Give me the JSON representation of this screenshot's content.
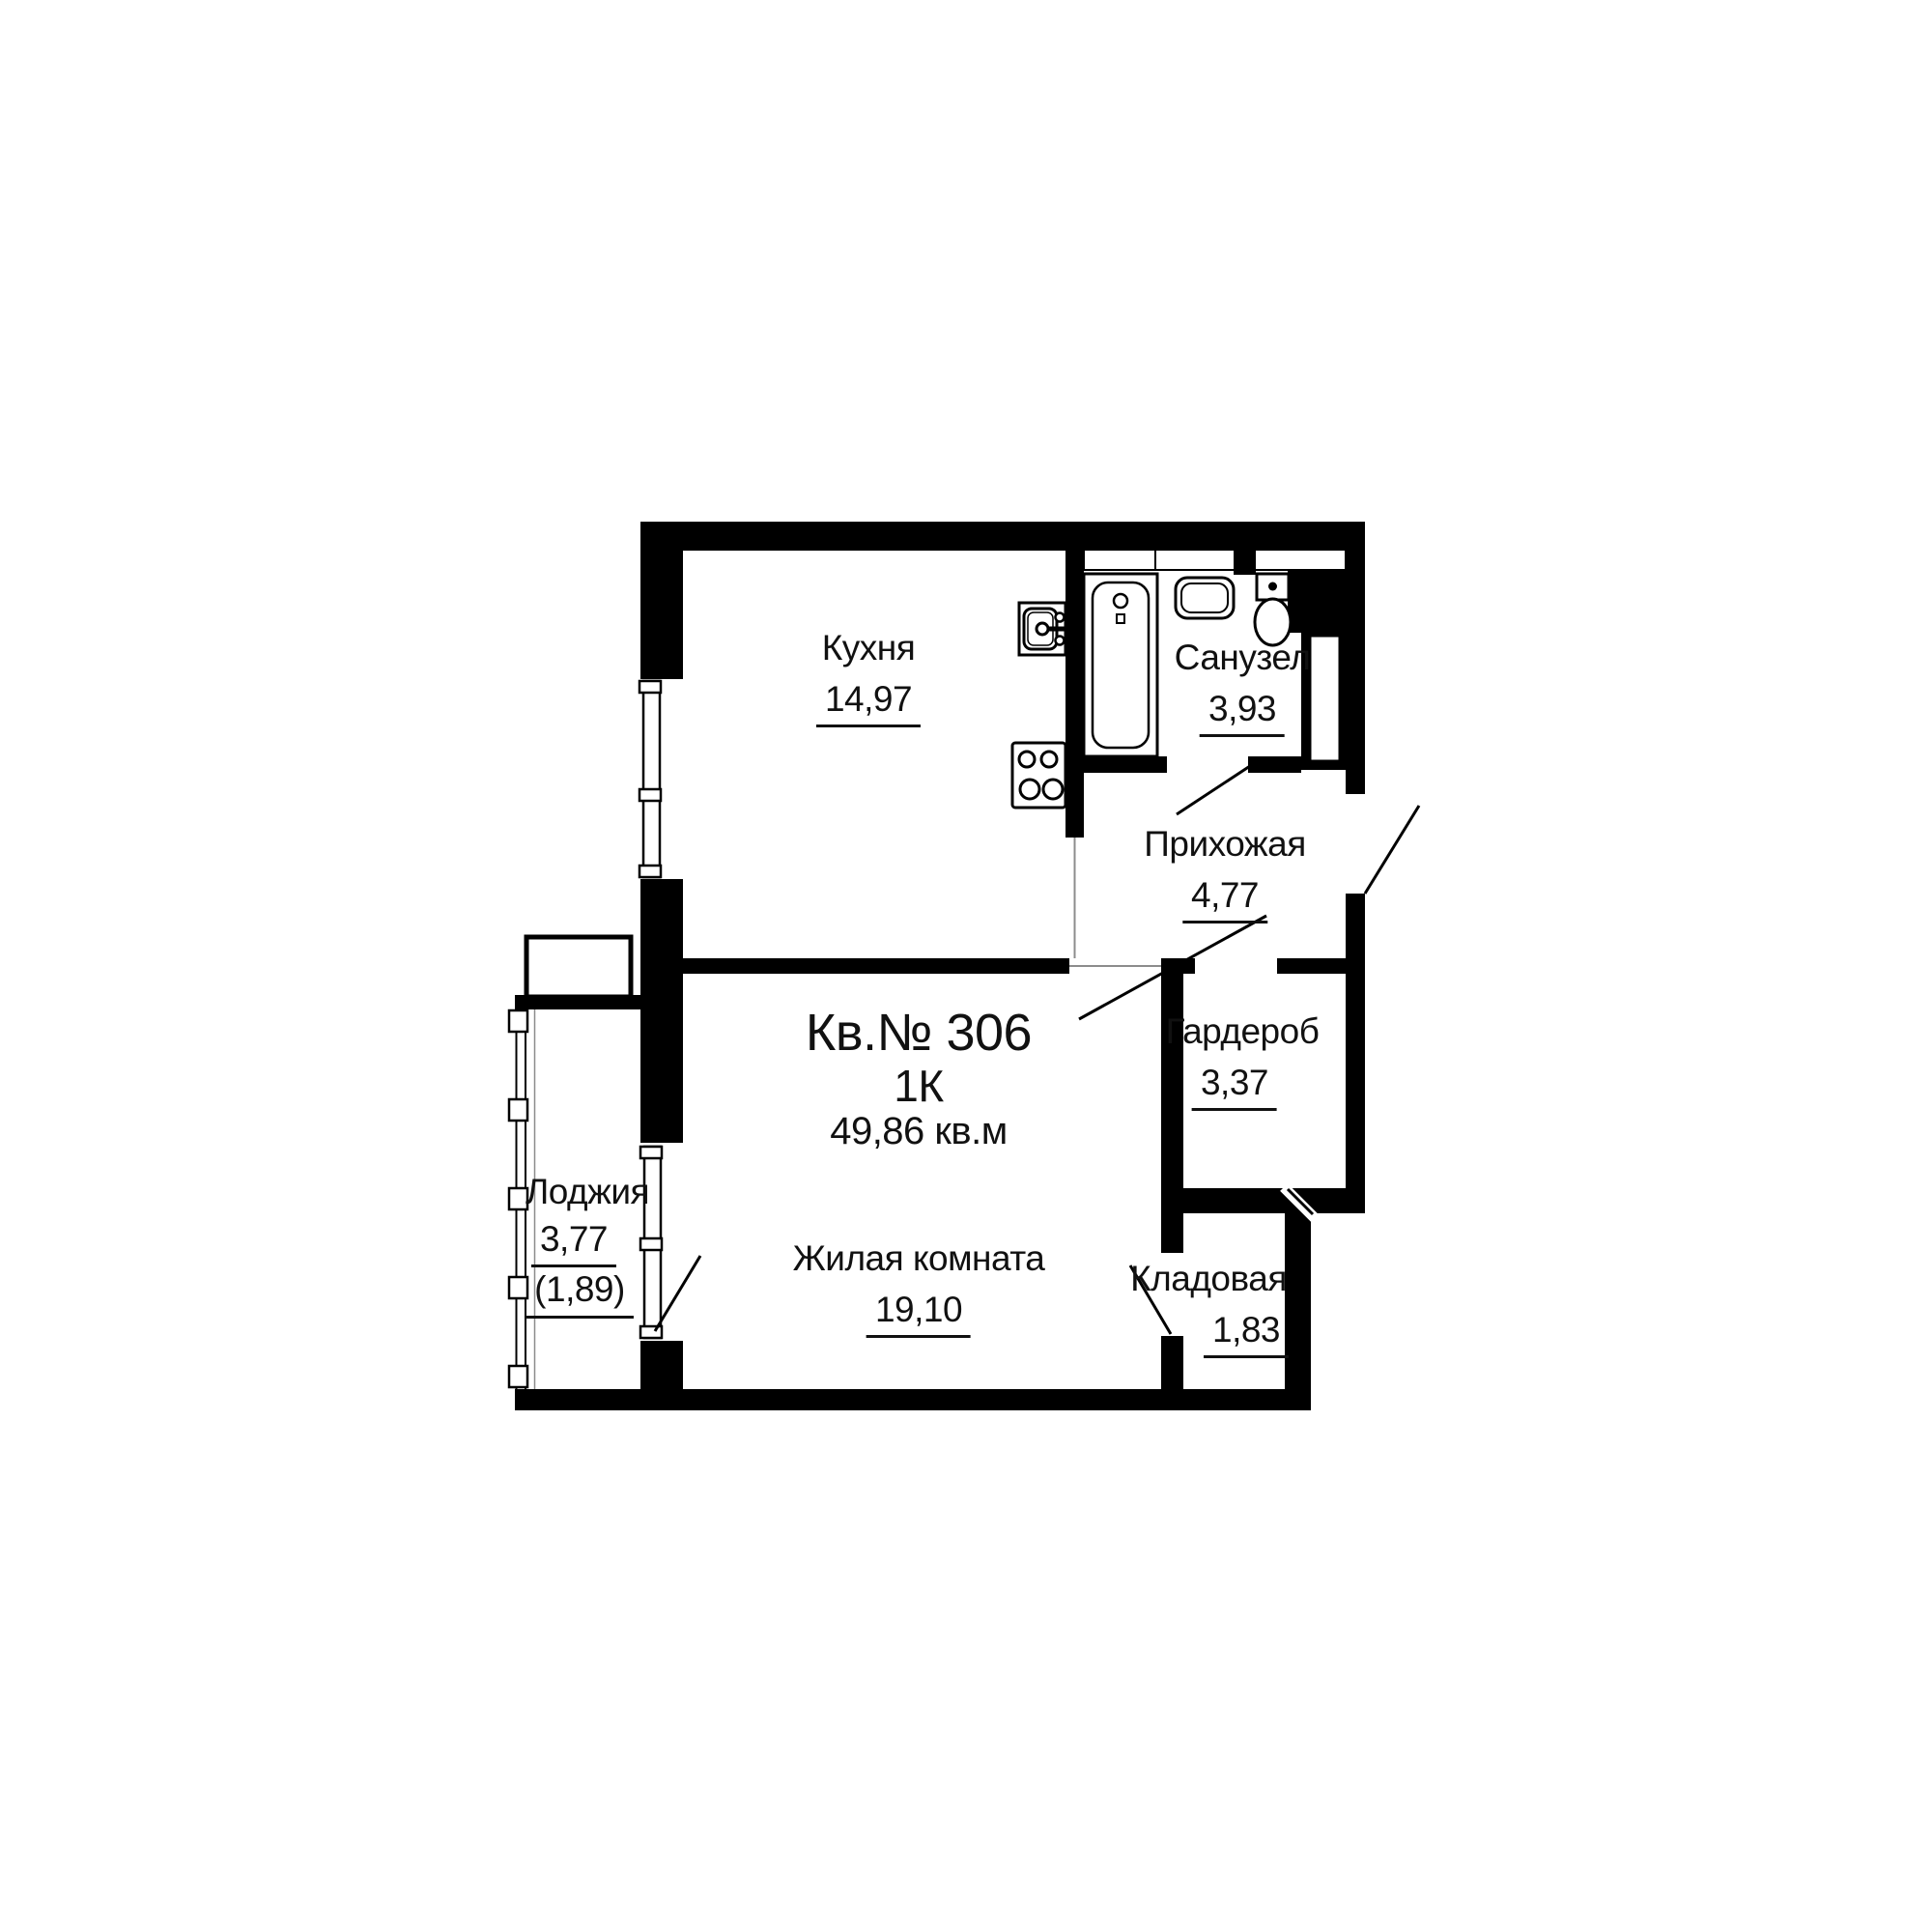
{
  "apartment": {
    "number": "Кв.№ 306",
    "rooms_type": "1К",
    "total_area": "49,86 кв.м"
  },
  "rooms": [
    {
      "id": "kitchen",
      "name": "Кухня",
      "area": "14,97"
    },
    {
      "id": "bathroom",
      "name": "Санузел",
      "area": "3,93"
    },
    {
      "id": "hallway",
      "name": "Прихожая",
      "area": "4,77"
    },
    {
      "id": "wardrobe",
      "name": "Гардероб",
      "area": "3,37"
    },
    {
      "id": "living-room",
      "name": "Жилая комната",
      "area": "19,10"
    },
    {
      "id": "storage",
      "name": "Кладовая",
      "area": "1,83"
    },
    {
      "id": "loggia",
      "name": "Лоджия",
      "area": "3,77",
      "area_reduced": "(1,89)"
    }
  ],
  "fixtures": [
    "bathtub",
    "washbasin",
    "toilet",
    "kitchen-sink",
    "stove",
    "ventilation-shaft"
  ],
  "colors": {
    "walls": "#000000",
    "background": "#ffffff",
    "thin_line": "#8c8c8c"
  }
}
